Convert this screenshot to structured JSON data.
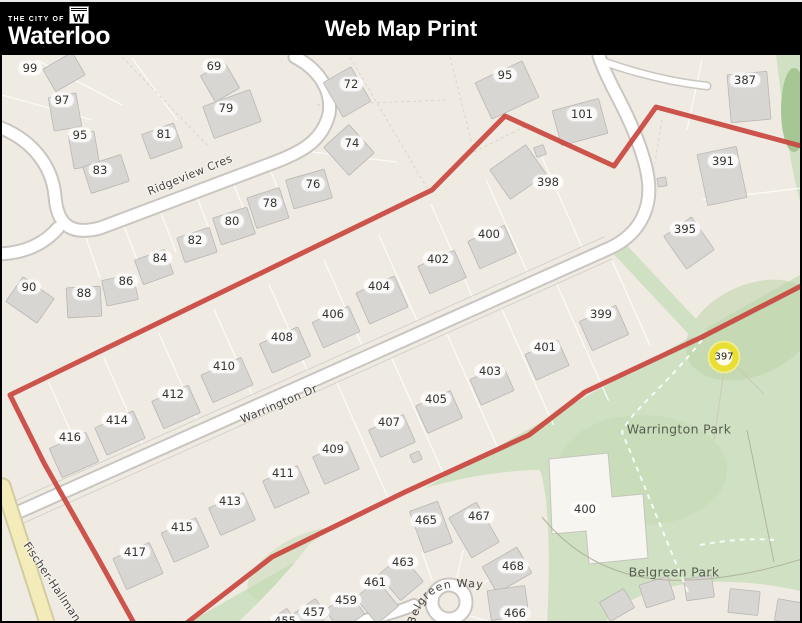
{
  "header": {
    "brand_top": "THE CITY OF",
    "brand_name": "Waterloo",
    "emblem_letter": "W",
    "title": "Web Map Print"
  },
  "map": {
    "street_labels": [
      {
        "name": "ridgeview-cres",
        "text": "Ridgeview Cres",
        "x": 188,
        "y": 175,
        "rot": -22
      },
      {
        "name": "warrington-dr",
        "text": "Warrington Dr",
        "x": 277,
        "y": 404,
        "rot": -23
      },
      {
        "name": "fischer-hallman",
        "text": "Fischer-Hallman",
        "x": 50,
        "y": 582,
        "rot": 56
      },
      {
        "name": "belgreen-way",
        "text": "Belgreen Way",
        "curved": true
      }
    ],
    "park_labels": [
      {
        "name": "warrington-park-label",
        "text": "Warrington Park",
        "x": 677,
        "y": 429
      },
      {
        "name": "belgreen-park-label",
        "text": "Belgreen Park",
        "x": 672,
        "y": 572
      }
    ],
    "marker": {
      "text": "397",
      "x": 722,
      "y": 357
    },
    "house_numbers": [
      {
        "t": "99",
        "x": 28,
        "y": 68
      },
      {
        "t": "97",
        "x": 60,
        "y": 100
      },
      {
        "t": "95",
        "x": 78,
        "y": 135
      },
      {
        "t": "83",
        "x": 98,
        "y": 170
      },
      {
        "t": "69",
        "x": 212,
        "y": 66
      },
      {
        "t": "79",
        "x": 224,
        "y": 108
      },
      {
        "t": "81",
        "x": 162,
        "y": 134
      },
      {
        "t": "72",
        "x": 349,
        "y": 84
      },
      {
        "t": "74",
        "x": 350,
        "y": 143
      },
      {
        "t": "76",
        "x": 311,
        "y": 184
      },
      {
        "t": "78",
        "x": 268,
        "y": 203
      },
      {
        "t": "80",
        "x": 230,
        "y": 221
      },
      {
        "t": "82",
        "x": 193,
        "y": 240
      },
      {
        "t": "84",
        "x": 158,
        "y": 258
      },
      {
        "t": "86",
        "x": 124,
        "y": 281
      },
      {
        "t": "88",
        "x": 82,
        "y": 293
      },
      {
        "t": "90",
        "x": 27,
        "y": 287
      },
      {
        "t": "95",
        "x": 503,
        "y": 75
      },
      {
        "t": "101",
        "x": 580,
        "y": 114
      },
      {
        "t": "387",
        "x": 743,
        "y": 80
      },
      {
        "t": "391",
        "x": 721,
        "y": 161
      },
      {
        "t": "395",
        "x": 683,
        "y": 229
      },
      {
        "t": "398",
        "x": 546,
        "y": 182
      },
      {
        "t": "400",
        "x": 487,
        "y": 234
      },
      {
        "t": "402",
        "x": 436,
        "y": 259
      },
      {
        "t": "404",
        "x": 377,
        "y": 286
      },
      {
        "t": "406",
        "x": 331,
        "y": 314
      },
      {
        "t": "408",
        "x": 280,
        "y": 337
      },
      {
        "t": "410",
        "x": 222,
        "y": 366
      },
      {
        "t": "412",
        "x": 171,
        "y": 394
      },
      {
        "t": "414",
        "x": 115,
        "y": 420
      },
      {
        "t": "416",
        "x": 68,
        "y": 437
      },
      {
        "t": "399",
        "x": 599,
        "y": 314
      },
      {
        "t": "401",
        "x": 543,
        "y": 347
      },
      {
        "t": "403",
        "x": 488,
        "y": 371
      },
      {
        "t": "405",
        "x": 434,
        "y": 399
      },
      {
        "t": "407",
        "x": 387,
        "y": 422
      },
      {
        "t": "409",
        "x": 331,
        "y": 449
      },
      {
        "t": "411",
        "x": 281,
        "y": 473
      },
      {
        "t": "413",
        "x": 228,
        "y": 501
      },
      {
        "t": "415",
        "x": 180,
        "y": 527
      },
      {
        "t": "417",
        "x": 133,
        "y": 552
      },
      {
        "t": "465",
        "x": 424,
        "y": 520
      },
      {
        "t": "467",
        "x": 477,
        "y": 516
      },
      {
        "t": "468",
        "x": 511,
        "y": 566
      },
      {
        "t": "466",
        "x": 513,
        "y": 613
      },
      {
        "t": "463",
        "x": 401,
        "y": 562
      },
      {
        "t": "461",
        "x": 373,
        "y": 582
      },
      {
        "t": "459",
        "x": 344,
        "y": 600
      },
      {
        "t": "457",
        "x": 312,
        "y": 612
      },
      {
        "t": "455",
        "x": 283,
        "y": 621
      },
      {
        "t": "400",
        "x": 583,
        "y": 509
      }
    ],
    "colors": {
      "background": "#f0ebe2",
      "road_fill": "#ffffff",
      "road_casing": "#c9c6c1",
      "building_fill": "#d8d6d3",
      "building_outline": "#b9b7b3",
      "boundary_red": "#c9463f",
      "park_green": "#cfe0c3",
      "park_green_dark": "#aecb9b",
      "road_yellow": "#f3ecba",
      "marker_yellow": "#e9de33"
    }
  }
}
